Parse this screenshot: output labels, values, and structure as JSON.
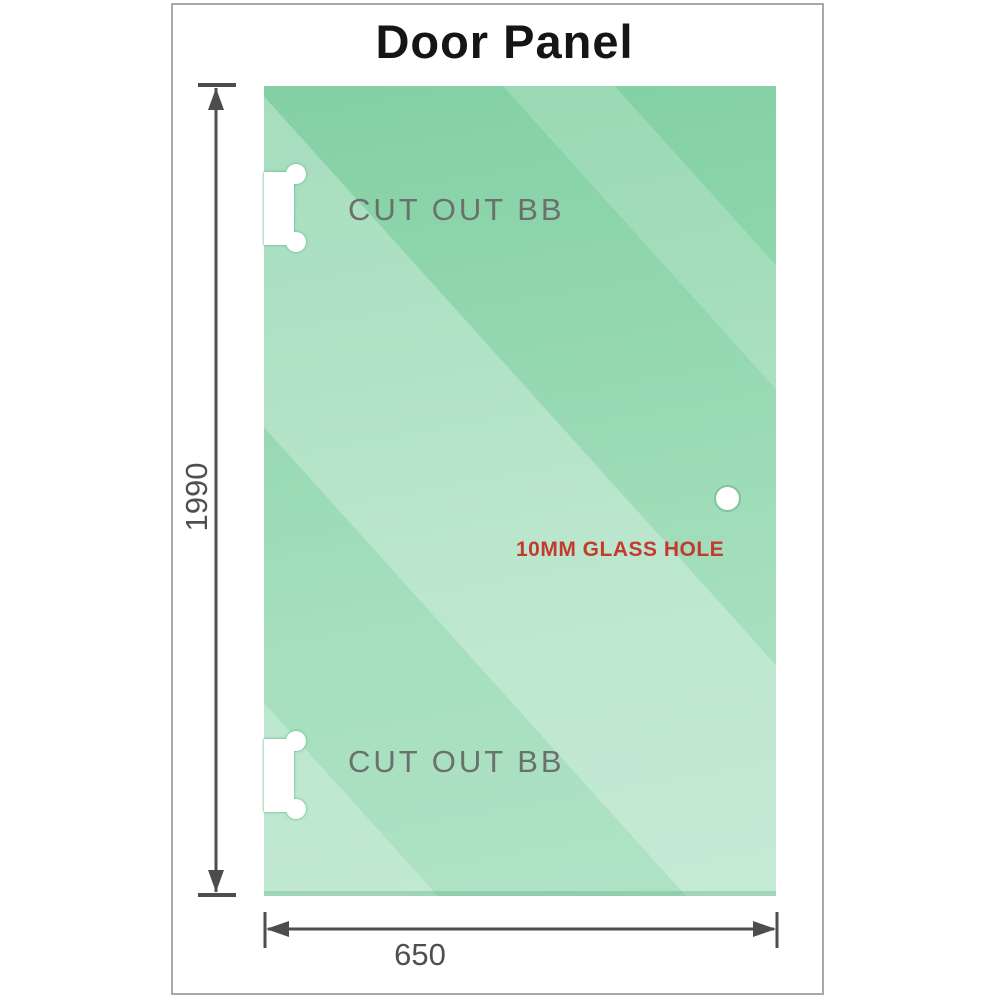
{
  "title": "Door Panel",
  "panel": {
    "cutouts": [
      {
        "label": "CUT OUT BB"
      },
      {
        "label": "CUT OUT BB"
      }
    ],
    "hole": {
      "label": "10MM GLASS HOLE"
    }
  },
  "dimensions": {
    "height": {
      "value": "1990"
    },
    "width": {
      "value": "650"
    }
  },
  "icons": {
    "vertical_dimension": "double-arrow-vertical",
    "horizontal_dimension": "double-arrow-horizontal"
  },
  "colors": {
    "glass_dark": "#7bcd9e",
    "glass_light": "#a9e0c0",
    "glass_reflection": "#bce8d0",
    "cutout_outline": "#69ba91",
    "dimension_gray": "#4d4d4d",
    "label_gray": "#6a716c",
    "hole_label_red": "#c43b2d",
    "title_black": "#151515",
    "frame_border": "#a8a8a8"
  }
}
